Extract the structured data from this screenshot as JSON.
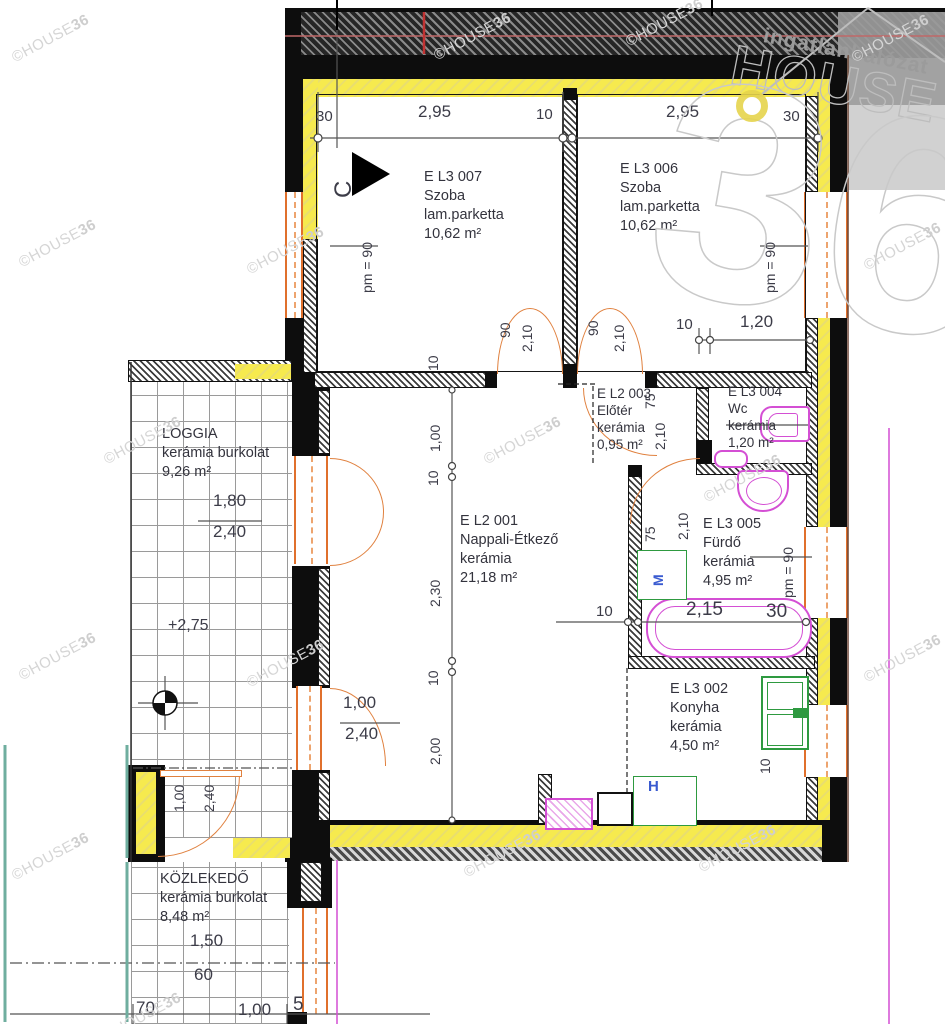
{
  "title": "Lakás alaprajz (floor plan)",
  "watermark": {
    "part1": "©HOUSE",
    "part2": "36",
    "positions": [
      [
        8,
        30
      ],
      [
        430,
        28
      ],
      [
        622,
        14
      ],
      [
        848,
        30
      ],
      [
        15,
        235
      ],
      [
        243,
        242
      ],
      [
        860,
        238
      ],
      [
        100,
        432
      ],
      [
        480,
        432
      ],
      [
        700,
        470
      ],
      [
        15,
        648
      ],
      [
        243,
        655
      ],
      [
        860,
        650
      ],
      [
        8,
        848
      ],
      [
        460,
        845
      ],
      [
        695,
        840
      ],
      [
        100,
        1008
      ]
    ]
  },
  "logo": {
    "network": "ingatlanhálózat",
    "brand": "HOUSE",
    "number": "36"
  },
  "colors": {
    "wall": "#0d0d0d",
    "insulation": "#f3e44a",
    "door": "#e0702c",
    "sanitary": "#d44fd4",
    "kitchen": "#2e9a40",
    "appliance_letter": "#3a5bd0",
    "watermark": "#d5d5d5",
    "dim_text": "#3c3c48"
  },
  "room_blocks": [
    {
      "x": 424,
      "y": 168,
      "lines": [
        "E L3 007",
        "Szoba",
        "lam.parketta",
        "10,62 m²"
      ]
    },
    {
      "x": 620,
      "y": 160,
      "lines": [
        "E L3 006",
        "Szoba",
        "lam.parketta",
        "10,62 m²"
      ]
    },
    {
      "x": 460,
      "y": 512,
      "lines": [
        "E L2 001",
        "Nappali-Étkező",
        "kerámia",
        "21,18 m²"
      ]
    },
    {
      "x": 597,
      "y": 385,
      "small": true,
      "lines": [
        "E L2 003",
        "Előtér",
        "kerámia",
        "0,95 m²"
      ]
    },
    {
      "x": 728,
      "y": 383,
      "small": true,
      "lines": [
        "E L3 004",
        "Wc",
        "kerámia",
        "1,20 m²"
      ]
    },
    {
      "x": 703,
      "y": 515,
      "lines": [
        "E L3 005",
        "Fürdő",
        "kerámia",
        "4,95 m²"
      ]
    },
    {
      "x": 670,
      "y": 680,
      "lines": [
        "E L3 002",
        "Konyha",
        "kerámia",
        "4,50 m²"
      ]
    },
    {
      "x": 162,
      "y": 425,
      "lines": [
        "LOGGIA",
        "kerámia burkolat",
        "9,26 m²"
      ]
    },
    {
      "x": 160,
      "y": 870,
      "lines": [
        "KÖZLEKEDŐ",
        "kerámia burkolat",
        "8,48 m²"
      ]
    }
  ],
  "labels": [
    {
      "t": "30",
      "x": 316,
      "y": 109,
      "fs": 15
    },
    {
      "t": "2,95",
      "x": 418,
      "y": 103,
      "fs": 17
    },
    {
      "t": "10",
      "x": 536,
      "y": 107,
      "fs": 15
    },
    {
      "t": "2,95",
      "x": 666,
      "y": 103,
      "fs": 17
    },
    {
      "t": "30",
      "x": 783,
      "y": 109,
      "fs": 15
    },
    {
      "t": "C",
      "x": 332,
      "y": 198,
      "rot": 1,
      "fs": 24,
      "n": "section-marker-label"
    },
    {
      "t": "pm = 90",
      "x": 360,
      "y": 293,
      "rot": 1,
      "fs": 14,
      "n": "parapet-label"
    },
    {
      "t": "pm = 90",
      "x": 763,
      "y": 293,
      "rot": 1,
      "fs": 14,
      "n": "parapet-label"
    },
    {
      "t": "90",
      "x": 498,
      "y": 338,
      "rot": 1,
      "fs": 14
    },
    {
      "t": "2,10",
      "x": 520,
      "y": 352,
      "rot": 1,
      "fs": 14
    },
    {
      "t": "90",
      "x": 586,
      "y": 336,
      "rot": 1,
      "fs": 14
    },
    {
      "t": "2,10",
      "x": 612,
      "y": 352,
      "rot": 1,
      "fs": 14
    },
    {
      "t": "10",
      "x": 426,
      "y": 371,
      "rot": 1,
      "fs": 14
    },
    {
      "t": "10",
      "x": 676,
      "y": 317,
      "fs": 15
    },
    {
      "t": "1,20",
      "x": 740,
      "y": 313,
      "fs": 17
    },
    {
      "t": "1,00",
      "x": 428,
      "y": 452,
      "rot": 1,
      "fs": 14
    },
    {
      "t": "10",
      "x": 426,
      "y": 486,
      "rot": 1,
      "fs": 14
    },
    {
      "t": "2,30",
      "x": 428,
      "y": 607,
      "rot": 1,
      "fs": 14
    },
    {
      "t": "10",
      "x": 426,
      "y": 686,
      "rot": 1,
      "fs": 14
    },
    {
      "t": "2,00",
      "x": 428,
      "y": 765,
      "rot": 1,
      "fs": 14
    },
    {
      "t": "75",
      "x": 643,
      "y": 409,
      "rot": 1,
      "fs": 14
    },
    {
      "t": "2,10",
      "x": 653,
      "y": 450,
      "rot": 1,
      "fs": 14
    },
    {
      "t": "75",
      "x": 643,
      "y": 542,
      "rot": 1,
      "fs": 14
    },
    {
      "t": "2,10",
      "x": 676,
      "y": 540,
      "rot": 1,
      "fs": 14
    },
    {
      "t": "pm = 90",
      "x": 781,
      "y": 598,
      "rot": 1,
      "fs": 14,
      "n": "parapet-label"
    },
    {
      "t": "1,80",
      "x": 213,
      "y": 492,
      "fs": 17
    },
    {
      "t": "2,40",
      "x": 213,
      "y": 523,
      "fs": 17
    },
    {
      "t": "+2,75",
      "x": 168,
      "y": 618,
      "fs": 16,
      "n": "level-label"
    },
    {
      "t": "1,00",
      "x": 343,
      "y": 694,
      "fs": 17
    },
    {
      "t": "2,40",
      "x": 345,
      "y": 725,
      "fs": 17
    },
    {
      "t": "1,00",
      "x": 172,
      "y": 812,
      "rot": 1,
      "fs": 14
    },
    {
      "t": "2,40",
      "x": 202,
      "y": 812,
      "rot": 1,
      "fs": 14
    },
    {
      "t": "10",
      "x": 596,
      "y": 604,
      "fs": 15
    },
    {
      "t": "2,15",
      "x": 686,
      "y": 600,
      "fs": 19
    },
    {
      "t": "30",
      "x": 766,
      "y": 602,
      "fs": 19
    },
    {
      "t": "M",
      "x": 651,
      "y": 586,
      "rot": 1,
      "fs": 14,
      "cls": "blue",
      "n": "washing-machine-label"
    },
    {
      "t": "H",
      "x": 648,
      "y": 779,
      "fs": 15,
      "cls": "blue",
      "n": "fridge-label"
    },
    {
      "t": "10",
      "x": 758,
      "y": 774,
      "rot": 1,
      "fs": 14
    },
    {
      "t": "1,50",
      "x": 190,
      "y": 932,
      "fs": 17
    },
    {
      "t": "60",
      "x": 194,
      "y": 966,
      "fs": 17
    },
    {
      "t": "70",
      "x": 136,
      "y": 999,
      "fs": 17
    },
    {
      "t": "1,00",
      "x": 238,
      "y": 1001,
      "fs": 17
    },
    {
      "t": "5",
      "x": 293,
      "y": 995,
      "fs": 19
    }
  ]
}
